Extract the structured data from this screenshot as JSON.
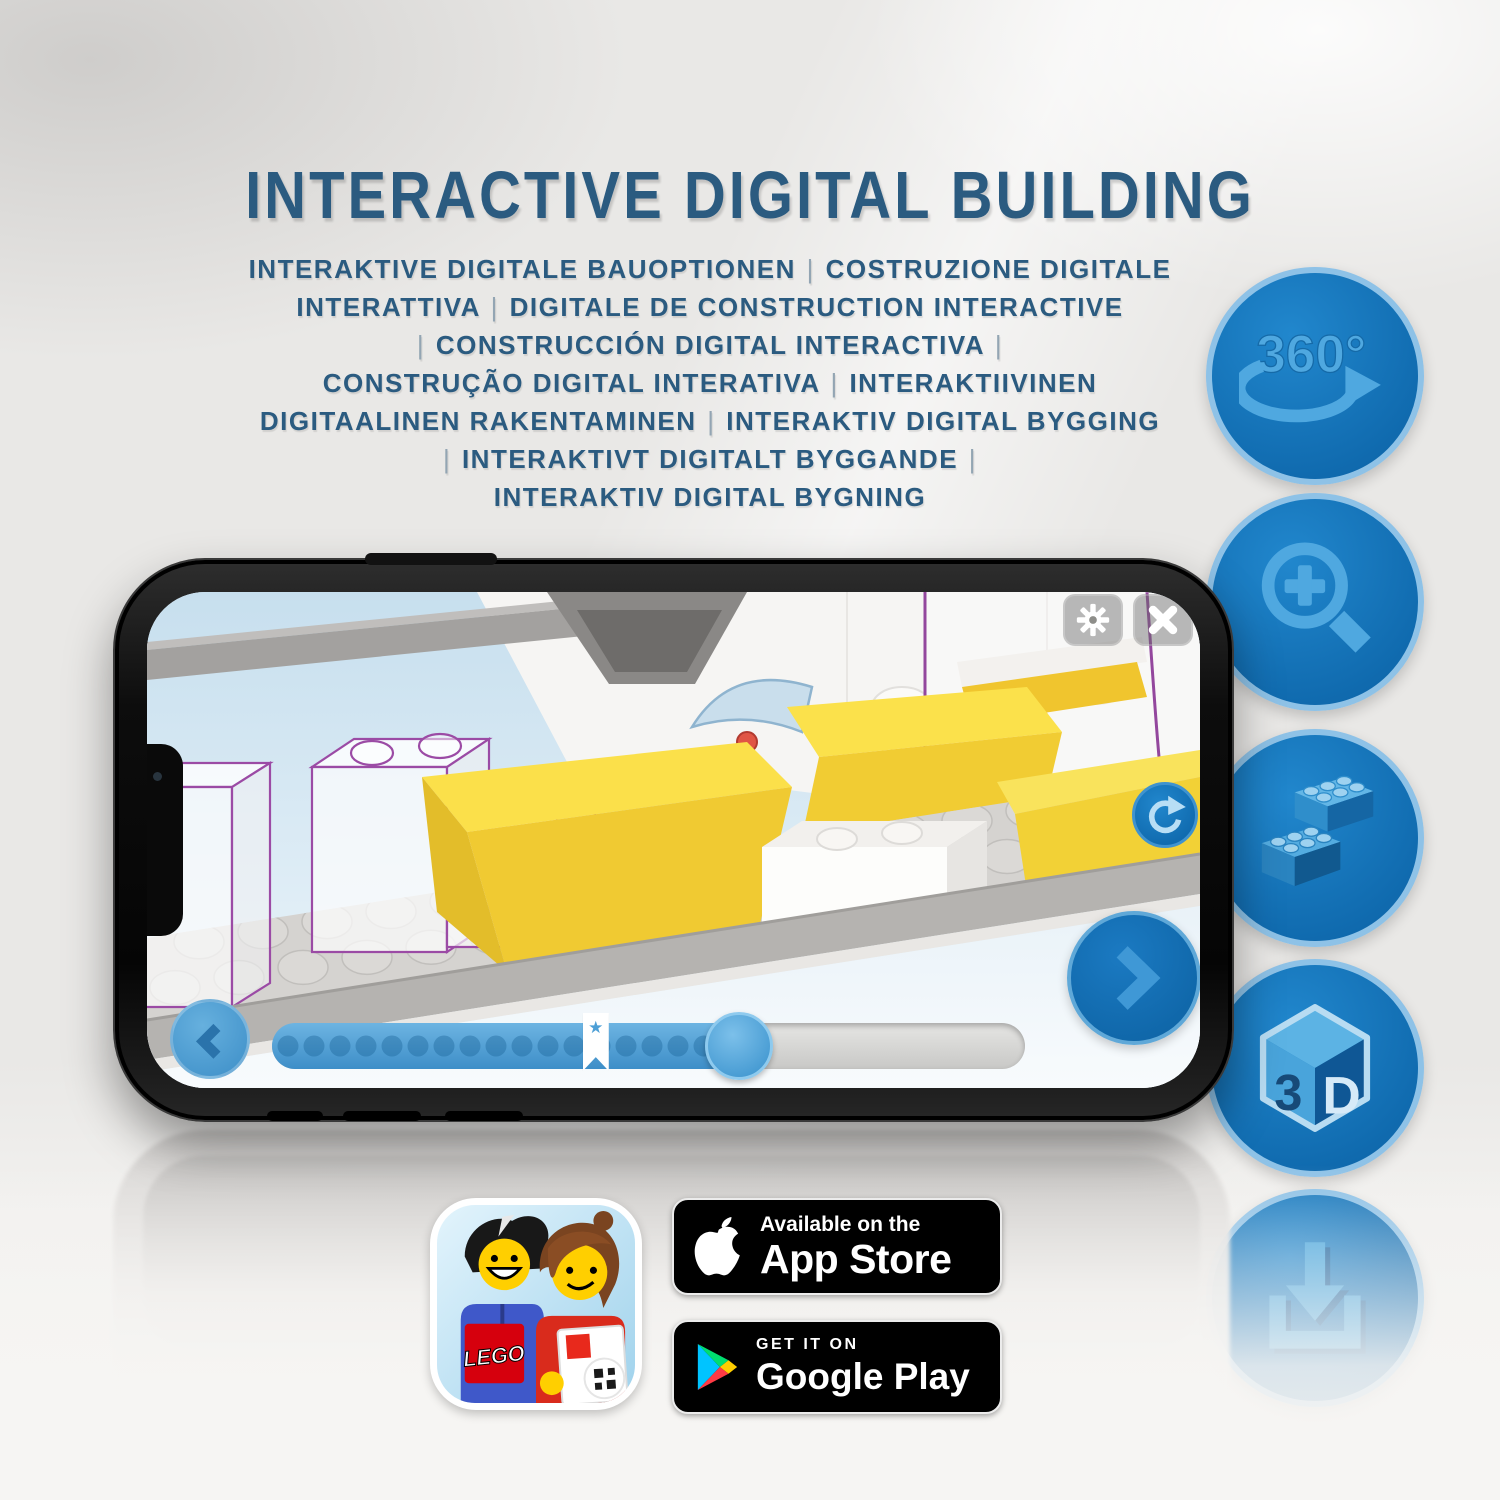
{
  "page": {
    "title": "INTERACTIVE DIGITAL BUILDING",
    "subtitle_lines": [
      "INTERAKTIVE DIGITALE BAUOPTIONEN | COSTRUZIONE DIGITALE",
      "INTERATTIVA | DIGITALE DE CONSTRUCTION INTERACTIVE",
      "| CONSTRUCCIÓN DIGITAL INTERACTIVA |",
      "CONSTRUÇÃO DIGITAL INTERATIVA | INTERAKTIIVINEN",
      "DIGITAALINEN RAKENTAMINEN | INTERAKTIV DIGITAL BYGGING",
      "| INTERAKTIVT DIGITALT BYGGANDE |",
      "INTERAKTIV DIGITAL BYGNING"
    ]
  },
  "colors": {
    "text_blue": "#2b5b80",
    "icon_circle_blue": "#1172b9",
    "icon_ring_blue": "#8ec2e7",
    "icon_glyph_blue": "#4fa8e0",
    "background_gray": "#e9e8e6"
  },
  "feature_icons": [
    {
      "name": "360-rotation-icon",
      "label": "360°"
    },
    {
      "name": "zoom-in-icon"
    },
    {
      "name": "bricks-icon"
    },
    {
      "name": "3d-cube-icon",
      "face_left": "3",
      "face_right": "D"
    },
    {
      "name": "download-icon"
    }
  ],
  "phone_app": {
    "progress": {
      "fill_percent": 62,
      "bookmark_percent": 43,
      "dot_count": 17,
      "star": "★"
    }
  },
  "store": {
    "lego_logo": "LEGO",
    "app_store": {
      "tagline": "Available on the",
      "name": "App Store"
    },
    "google_play": {
      "tagline": "GET IT ON",
      "name": "Google Play"
    }
  }
}
